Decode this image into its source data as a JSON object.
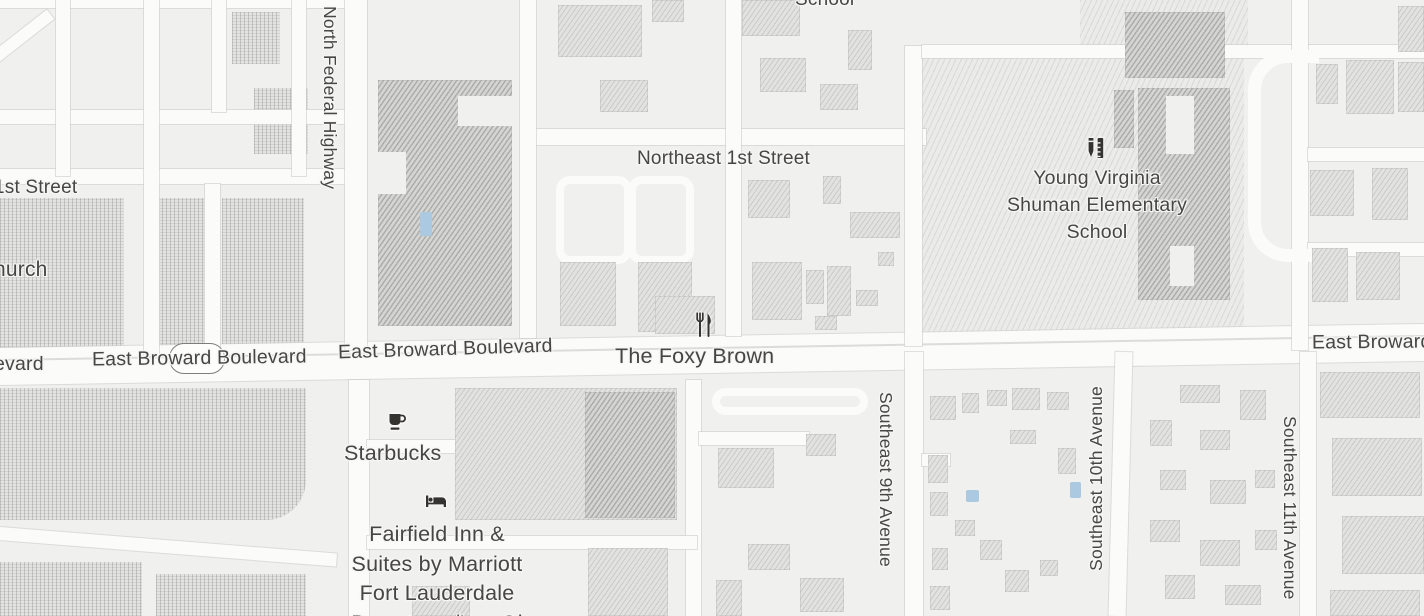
{
  "map": {
    "colors": {
      "background": "#f0f0ee",
      "road": "#fbfbfa",
      "building": "#e2e2e0",
      "building_dark": "#d5d5d3",
      "water": "#abc9e1",
      "label": "#474645",
      "icon": "#34332f"
    },
    "street_labels": [
      {
        "name": "label-north-federal-highway",
        "text": "North Federal Highway",
        "x": 318,
        "y": 6,
        "size": 17.5,
        "mode": "vtb"
      },
      {
        "name": "label-northeast-1st-street",
        "text": "Northeast 1st Street",
        "x": 637,
        "y": 146,
        "size": 19
      },
      {
        "name": "label-school-partial-top",
        "text": "School",
        "x": 795,
        "y": -13,
        "size": 19
      },
      {
        "name": "label-1st-street-partial",
        "text": "1st Street",
        "x": -6,
        "y": 175,
        "size": 19
      },
      {
        "name": "label-church-partial",
        "text": "hurch",
        "x": -6,
        "y": 256,
        "size": 21
      },
      {
        "name": "label-boulevard-partial",
        "text": "evard",
        "x": -6,
        "y": 351,
        "size": 19.5
      },
      {
        "name": "label-east-broward-boulevard-west",
        "text": "East Broward Boulevard",
        "x": 92,
        "y": 345,
        "size": 19.5,
        "rot": -0.8
      },
      {
        "name": "label-east-broward-boulevard-mid",
        "text": "East Broward Boulevard",
        "x": 338,
        "y": 336,
        "size": 19.5,
        "rot": -1.8
      },
      {
        "name": "label-east-broward-partial-east",
        "text": "East Broward",
        "x": 1312,
        "y": 329,
        "size": 19.5,
        "rot": -0.5
      },
      {
        "name": "label-southeast-9th-avenue",
        "text": "Southeast 9th Avenue",
        "x": 874,
        "y": 392,
        "size": 17.5,
        "mode": "vtb"
      },
      {
        "name": "label-southeast-10th-avenue",
        "text": "Southeast 10th Avenue",
        "x": 1084,
        "y": 386,
        "size": 17.5,
        "mode": "vbt"
      },
      {
        "name": "label-southeast-11th-avenue",
        "text": "Southeast 11th Avenue",
        "x": 1278,
        "y": 416,
        "size": 17.5,
        "mode": "vtb"
      }
    ],
    "poi_labels": [
      {
        "name": "label-the-foxy-brown",
        "lines": [
          "The Foxy Brown"
        ],
        "x": 615,
        "y": 342,
        "size": 21.5
      },
      {
        "name": "label-starbucks",
        "lines": [
          "Starbucks"
        ],
        "x": 344,
        "y": 439,
        "size": 21.5
      },
      {
        "name": "label-fairfield-inn",
        "lines": [
          "Fairfield Inn &",
          "Suites by Marriott",
          "Fort Lauderdale",
          "Downtown/Las Ol"
        ],
        "x": 317,
        "y": 520,
        "w": 240,
        "size": 21.5
      },
      {
        "name": "label-young-virginia-shuman-elementary-school",
        "lines": [
          "Young Virginia",
          "Shuman Elementary",
          "School"
        ],
        "x": 967,
        "y": 165,
        "w": 260,
        "size": 19.5
      }
    ],
    "poi_icons": [
      {
        "name": "restaurant-icon",
        "x": 693,
        "y": 312
      },
      {
        "name": "cafe-icon",
        "x": 387,
        "y": 411
      },
      {
        "name": "lodging-icon",
        "x": 424,
        "y": 491
      },
      {
        "name": "school-icon",
        "x": 1084,
        "y": 136
      }
    ],
    "route_shield": {
      "x": 169,
      "y": 343,
      "w": 54,
      "h": 29
    },
    "features": {
      "parcels_dots": [
        [
          0,
          198,
          124,
          158
        ],
        [
          146,
          198,
          58,
          158
        ],
        [
          222,
          198,
          82,
          158
        ],
        [
          0,
          388,
          306,
          132
        ],
        [
          0,
          562,
          142,
          54
        ],
        [
          156,
          574,
          150,
          42
        ],
        [
          232,
          12,
          48,
          52
        ],
        [
          254,
          88,
          54,
          66
        ]
      ],
      "parcels_hatch": [
        [
          922,
          48,
          322,
          286
        ],
        [
          1080,
          0,
          168,
          50
        ]
      ],
      "roads": [
        [
          -8,
          349,
          1440,
          24,
          -0.97
        ],
        [
          -8,
          336,
          1440,
          11,
          -0.97
        ],
        [
          522,
          129,
          404,
          16
        ],
        [
          0,
          0,
          348,
          8
        ],
        [
          0,
          110,
          350,
          14
        ],
        [
          0,
          169,
          350,
          15
        ],
        [
          56,
          0,
          14,
          176
        ],
        [
          144,
          0,
          15,
          356
        ],
        [
          212,
          0,
          14,
          112
        ],
        [
          292,
          0,
          14,
          176
        ],
        [
          205,
          184,
          15,
          172
        ],
        [
          -30,
          36,
          90,
          12,
          -38
        ],
        [
          345,
          0,
          22,
          350
        ],
        [
          520,
          0,
          16,
          338
        ],
        [
          726,
          0,
          15,
          336
        ],
        [
          905,
          46,
          17,
          300
        ],
        [
          922,
          45,
          502,
          13
        ],
        [
          1292,
          0,
          16,
          350
        ],
        [
          1308,
          148,
          116,
          13
        ],
        [
          1308,
          243,
          116,
          13
        ],
        [
          349,
          380,
          20,
          236
        ],
        [
          686,
          380,
          15,
          236
        ],
        [
          905,
          352,
          18,
          264
        ],
        [
          1112,
          352,
          17,
          264,
          1.5
        ],
        [
          1300,
          352,
          16,
          264
        ],
        [
          367,
          440,
          120,
          13
        ],
        [
          473,
          447,
          13,
          72
        ],
        [
          367,
          536,
          330,
          13
        ],
        [
          699,
          432,
          110,
          13
        ],
        [
          922,
          454,
          28,
          12
        ],
        [
          -8,
          540,
          345,
          13,
          4.5
        ]
      ],
      "lanes": [
        [
          556,
          176,
          60,
          72
        ],
        [
          628,
          176,
          50,
          72
        ],
        [
          712,
          388,
          140,
          11
        ]
      ],
      "loop": [
        1248,
        50,
        58,
        186
      ],
      "buildings": [
        [
          378,
          80,
          134,
          246,
          1
        ],
        [
          558,
          5,
          84,
          52
        ],
        [
          600,
          80,
          48,
          32
        ],
        [
          652,
          0,
          32,
          22
        ],
        [
          742,
          0,
          58,
          36
        ],
        [
          760,
          58,
          46,
          34
        ],
        [
          820,
          84,
          38,
          26
        ],
        [
          848,
          30,
          24,
          40
        ],
        [
          560,
          262,
          56,
          64
        ],
        [
          638,
          262,
          54,
          70
        ],
        [
          655,
          296,
          60,
          38
        ],
        [
          748,
          180,
          42,
          38
        ],
        [
          823,
          176,
          18,
          28
        ],
        [
          850,
          212,
          50,
          26
        ],
        [
          752,
          262,
          50,
          58
        ],
        [
          806,
          270,
          18,
          34
        ],
        [
          827,
          266,
          24,
          50
        ],
        [
          856,
          290,
          22,
          16
        ],
        [
          815,
          316,
          22,
          14
        ],
        [
          878,
          252,
          16,
          14
        ],
        [
          1125,
          12,
          100,
          66,
          1
        ],
        [
          1138,
          88,
          92,
          212,
          1
        ],
        [
          1114,
          90,
          20,
          58,
          1
        ],
        [
          1398,
          6,
          26,
          46
        ],
        [
          1316,
          64,
          22,
          40
        ],
        [
          1346,
          60,
          48,
          54
        ],
        [
          1398,
          62,
          26,
          50
        ],
        [
          1310,
          170,
          44,
          46
        ],
        [
          1372,
          168,
          36,
          52
        ],
        [
          1312,
          248,
          36,
          54
        ],
        [
          1356,
          252,
          44,
          48
        ],
        [
          455,
          388,
          222,
          132
        ],
        [
          585,
          392,
          90,
          126,
          1
        ],
        [
          588,
          548,
          80,
          68
        ],
        [
          412,
          586,
          58,
          30
        ],
        [
          718,
          448,
          56,
          40
        ],
        [
          806,
          434,
          30,
          22
        ],
        [
          748,
          544,
          42,
          26
        ],
        [
          800,
          578,
          44,
          34
        ],
        [
          716,
          580,
          26,
          36
        ],
        [
          930,
          396,
          26,
          24
        ],
        [
          962,
          393,
          17,
          20
        ],
        [
          987,
          390,
          20,
          16
        ],
        [
          1012,
          388,
          28,
          22
        ],
        [
          1047,
          392,
          22,
          18
        ],
        [
          928,
          455,
          20,
          28
        ],
        [
          930,
          492,
          18,
          24
        ],
        [
          955,
          520,
          20,
          16
        ],
        [
          932,
          548,
          16,
          22
        ],
        [
          980,
          540,
          22,
          20
        ],
        [
          1005,
          570,
          24,
          22
        ],
        [
          1040,
          560,
          18,
          16
        ],
        [
          930,
          586,
          20,
          24
        ],
        [
          1010,
          430,
          26,
          14
        ],
        [
          1058,
          448,
          18,
          26
        ],
        [
          1180,
          385,
          40,
          18
        ],
        [
          1150,
          420,
          22,
          26
        ],
        [
          1200,
          430,
          30,
          20
        ],
        [
          1240,
          390,
          26,
          30
        ],
        [
          1160,
          470,
          26,
          20
        ],
        [
          1210,
          480,
          36,
          24
        ],
        [
          1255,
          470,
          20,
          18
        ],
        [
          1150,
          520,
          30,
          22
        ],
        [
          1200,
          540,
          40,
          26
        ],
        [
          1255,
          530,
          22,
          20
        ],
        [
          1165,
          575,
          30,
          24
        ],
        [
          1225,
          585,
          36,
          20
        ],
        [
          1320,
          372,
          100,
          46
        ],
        [
          1332,
          438,
          90,
          58
        ],
        [
          1342,
          516,
          82,
          58
        ],
        [
          1330,
          590,
          90,
          26
        ]
      ],
      "notches": [
        [
          378,
          152,
          28,
          42
        ],
        [
          458,
          96,
          54,
          30
        ],
        [
          1166,
          96,
          28,
          58
        ],
        [
          1170,
          246,
          24,
          40
        ]
      ],
      "pools": [
        [
          420,
          212,
          12,
          24
        ],
        [
          966,
          490,
          13,
          12
        ],
        [
          1070,
          482,
          11,
          16
        ]
      ]
    }
  }
}
